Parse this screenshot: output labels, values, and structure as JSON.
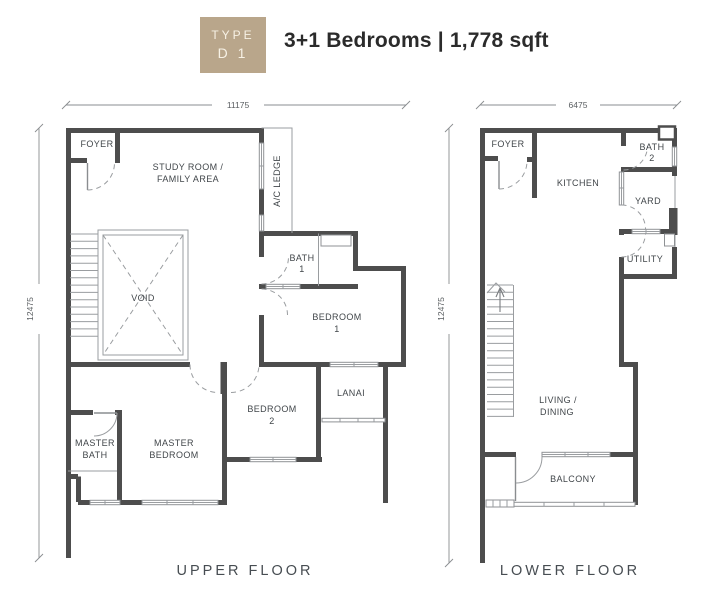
{
  "header": {
    "badge_line1": "TYPE",
    "badge_line2": "D 1",
    "title": "3+1 Bedrooms | 1,778 sqft"
  },
  "colors": {
    "badge": "#b9a68b",
    "badge_text": "#f7f1e5",
    "wall": "#4d4d4d",
    "thin_line": "#9a9da0",
    "label_text": "#41464a"
  },
  "upper": {
    "floor_label": "UPPER FLOOR",
    "dim_width": "11175",
    "dim_height": "12475",
    "rooms": {
      "foyer": "FOYER",
      "study1": "STUDY ROOM /",
      "study2": "FAMILY AREA",
      "ac_ledge": "A/C LEDGE",
      "void": "VOID",
      "bath1a": "BATH",
      "bath1b": "1",
      "bed1a": "BEDROOM",
      "bed1b": "1",
      "lanai": "LANAI",
      "bed2a": "BEDROOM",
      "bed2b": "2",
      "mbra": "MASTER",
      "mbrb": "BEDROOM",
      "mbatha": "MASTER",
      "mbathb": "BATH"
    }
  },
  "lower": {
    "floor_label": "LOWER FLOOR",
    "dim_width": "6475",
    "dim_height": "12475",
    "rooms": {
      "foyer": "FOYER",
      "kitchen": "KITCHEN",
      "bath2a": "BATH",
      "bath2b": "2",
      "yard": "YARD",
      "utility": "UTILITY",
      "livinga": "LIVING /",
      "livingb": "DINING",
      "balcony": "BALCONY"
    }
  }
}
